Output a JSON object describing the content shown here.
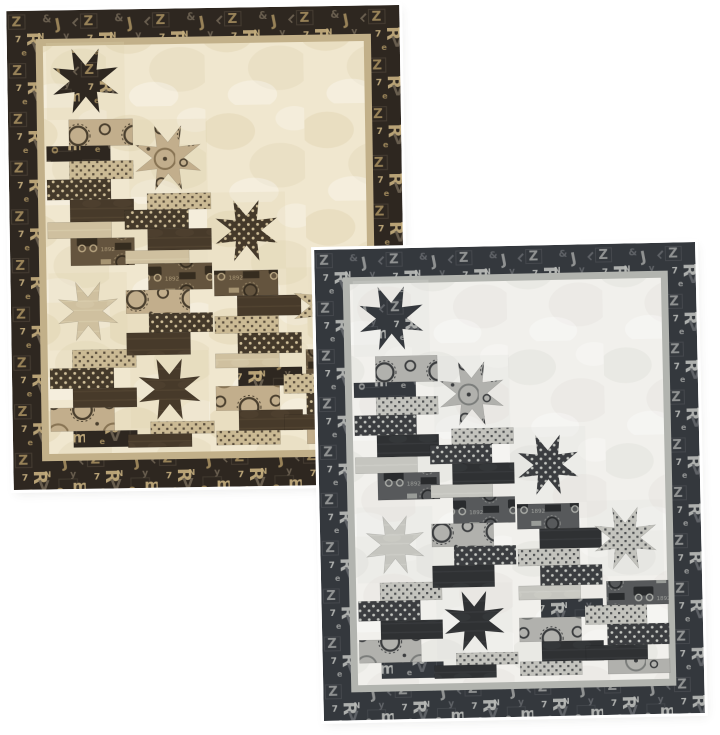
{
  "canvas": {
    "width": 720,
    "height": 735,
    "background": "#ffffff"
  },
  "image_subject": "Two overlapping quilt mockups (same star-and-stacked-strips design) in a tan/brown colorway and a gray/black colorway, each with a letterpress-type print border",
  "fabric_glyphs": [
    "Z",
    "R",
    "&",
    "J",
    "7",
    "V",
    "o",
    "m",
    "L",
    "e",
    "y",
    "N"
  ],
  "trucks_digits": "1892",
  "design": {
    "border_width": 28,
    "strip_width": 7,
    "field": {
      "w": 312,
      "h": 402
    },
    "star_inner_ratio": 0.45,
    "stars": [
      {
        "cx": 41,
        "cy": 35,
        "r": 34,
        "fabric": "letterpress"
      },
      {
        "cx": 120,
        "cy": 112,
        "r": 34,
        "fabric": "gears"
      },
      {
        "cx": 195,
        "cy": 185,
        "r": 32,
        "fabric": "dotsDark"
      },
      {
        "cx": 40,
        "cy": 262,
        "r": 31,
        "fabric": "solidLight"
      },
      {
        "cx": 118,
        "cy": 340,
        "r": 32,
        "fabric": "solidDark"
      },
      {
        "cx": 271,
        "cy": 260,
        "r": 33,
        "fabric": "dotsLight"
      }
    ],
    "bar_width": 62,
    "bar_offset": 22,
    "towers": [
      {
        "x": 2,
        "y": 73,
        "bars": [
          [
            "gears",
            1,
            26
          ],
          [
            "letterpress",
            0,
            15
          ],
          [
            "dotsLight",
            1,
            18
          ],
          [
            "dotsDark",
            0,
            20
          ],
          [
            "solidDark",
            1,
            22
          ],
          [
            "solidLight",
            0,
            16
          ],
          [
            "trucks",
            1,
            27
          ]
        ]
      },
      {
        "x": 2,
        "y": 300,
        "bars": [
          [
            "dotsLight",
            1,
            18
          ],
          [
            "dotsDark",
            0,
            20
          ],
          [
            "solidDark",
            1,
            19
          ],
          [
            "gears",
            0,
            23
          ],
          [
            "letterpress",
            1,
            16
          ]
        ]
      },
      {
        "x": 77,
        "y": 147,
        "bars": [
          [
            "dotsLight",
            1,
            16
          ],
          [
            "dotsDark",
            0,
            19
          ],
          [
            "solidDark",
            1,
            21
          ],
          [
            "solidLight",
            0,
            13
          ],
          [
            "trucks",
            1,
            26
          ],
          [
            "gears",
            0,
            23
          ],
          [
            "dotsDark",
            1,
            19
          ],
          [
            "solidDark",
            0,
            22
          ]
        ]
      },
      {
        "x": 77,
        "y": 372,
        "bars": [
          [
            "dotsLight",
            1,
            12
          ],
          [
            "solidDark",
            0,
            13
          ]
        ]
      },
      {
        "x": 163,
        "y": 224,
        "bars": [
          [
            "trucks",
            0,
            25
          ],
          [
            "solidDark",
            1,
            20
          ],
          [
            "dotsLight",
            0,
            17
          ],
          [
            "dotsDark",
            1,
            20
          ],
          [
            "solidLight",
            0,
            14
          ],
          [
            "letterpress",
            1,
            18
          ],
          [
            "gears",
            0,
            24
          ],
          [
            "solidDark",
            1,
            20
          ],
          [
            "dotsLight",
            0,
            14
          ]
        ]
      },
      {
        "x": 229,
        "y": 303,
        "bars": [
          [
            "trucks",
            1,
            24
          ],
          [
            "dotsLight",
            0,
            19
          ],
          [
            "dotsDark",
            1,
            21
          ],
          [
            "solidDark",
            0,
            15
          ],
          [
            "gears",
            1,
            14
          ]
        ]
      }
    ]
  },
  "quilts": [
    {
      "id": "quilt-tan",
      "name": "tan-brown colorway",
      "x": 10,
      "y": 8,
      "width": 393,
      "height": 479,
      "rotation": -0.9,
      "palette": {
        "borderBase": "#2e2720",
        "glyphA": "#a18a5c",
        "glyphB": "#c3ad7d",
        "glyphC": "#6e6352",
        "strip": "#c2b089",
        "fieldBase": "#f0e7cf",
        "fieldMottle": "#e0d2b0",
        "solidDark": "#473a2a",
        "solidDarkStreak": "#60513c",
        "solidLight": "#cfc09f",
        "solidLightStreak": "#e0d3b4",
        "gearsBase": "#c2ae8c",
        "gearsDark": "#4a3f2e",
        "gearsMid": "#887454",
        "dotsDarkBase": "#44392a",
        "dotsDarkDot": "#cfbe98",
        "dotsLightBase": "#cbba94",
        "dotsLightDot": "#453a2b",
        "trucksBase": "#64543e",
        "trucksDark": "#352c1f",
        "trucksLight": "#b7a480"
      }
    },
    {
      "id": "quilt-gray",
      "name": "gray-black colorway",
      "x": 319,
      "y": 246,
      "width": 381,
      "height": 471,
      "rotation": -1.2,
      "palette": {
        "borderBase": "#34383d",
        "glyphA": "#989a99",
        "glyphB": "#b9bbb8",
        "glyphC": "#63666a",
        "strip": "#b2b4af",
        "fieldBase": "#f1f0ec",
        "fieldMottle": "#e1e0da",
        "solidDark": "#2f3133",
        "solidDarkStreak": "#45474a",
        "solidLight": "#c5c5bf",
        "solidLightStreak": "#d6d6d0",
        "gearsBase": "#b1b1ad",
        "gearsDark": "#3a3c3e",
        "gearsMid": "#7b7d7b",
        "dotsDarkBase": "#3b3d40",
        "dotsDarkDot": "#c4c6c1",
        "dotsLightBase": "#c3c3bd",
        "dotsLightDot": "#3b3d40",
        "trucksBase": "#57595b",
        "trucksDark": "#292b2d",
        "trucksLight": "#aaaca7"
      }
    }
  ]
}
